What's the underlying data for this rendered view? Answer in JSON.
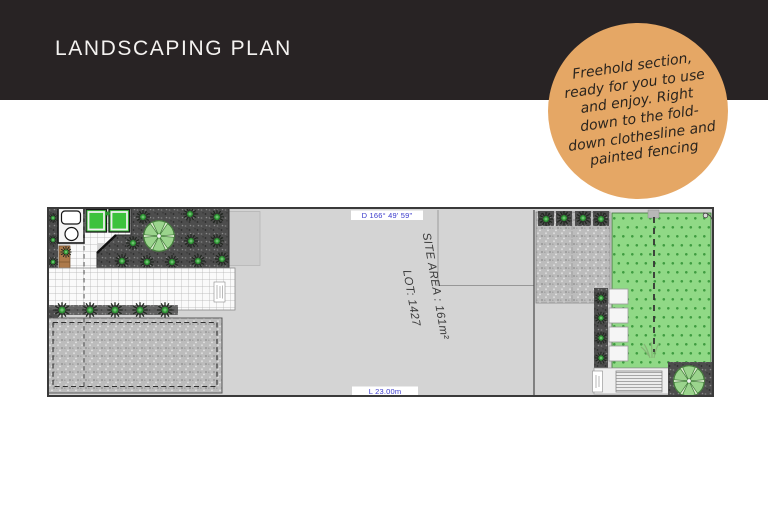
{
  "header": {
    "title": "LANDSCAPING PLAN",
    "bg_color": "#282324",
    "text_color": "#f4f2f0"
  },
  "badge": {
    "bg_color": "#e5a765",
    "text_color": "#2a241e",
    "lines": [
      "Freehold section,",
      "ready for you to use",
      "and enjoy. Right",
      "down to the fold-",
      "down clothesline and",
      "painted fencing"
    ]
  },
  "plan": {
    "labels": {
      "bearing": "D 166° 49' 59\"",
      "length": "L 23.00m",
      "site_area": "SITE AREA : 161m²",
      "lot": "LOT: 1427"
    },
    "colors": {
      "surface": "#d4d4d4",
      "border": "#3a3a3a",
      "dimension_text": "#3a3acb",
      "area_text": "#3b3b3b",
      "lawn": "#90d986",
      "lawn_dot": "#3e9c40",
      "planter": "#3cc23c",
      "timber": "#ad7a4b",
      "dark_bed": "#4d4d4d",
      "gravel": "#bcbcbc",
      "shrub_green": "#2e9434",
      "tree_green": "#9bd48d"
    }
  }
}
